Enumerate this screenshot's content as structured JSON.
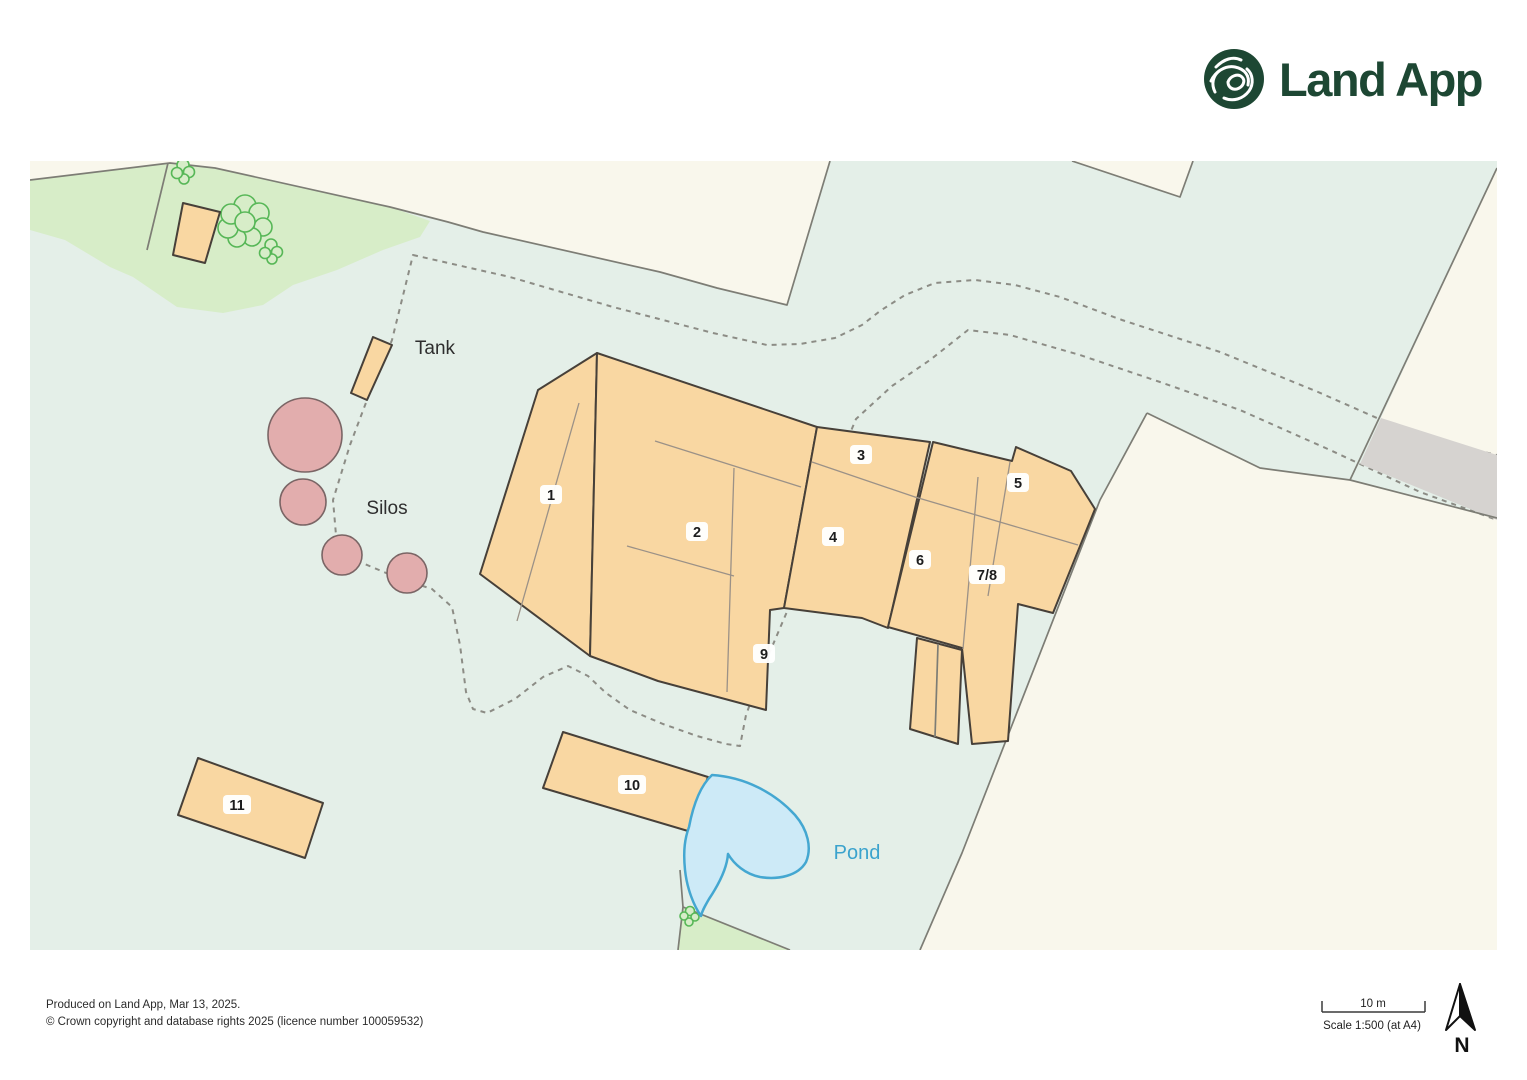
{
  "header": {
    "logo_text": "Land App"
  },
  "map": {
    "area_labels": {
      "tank": "Tank",
      "silos": "Silos",
      "pond": "Pond"
    },
    "buildings": [
      {
        "label": "1"
      },
      {
        "label": "2"
      },
      {
        "label": "3"
      },
      {
        "label": "4"
      },
      {
        "label": "5"
      },
      {
        "label": "6"
      },
      {
        "label": "7/8"
      },
      {
        "label": "9"
      },
      {
        "label": "10"
      },
      {
        "label": "11"
      }
    ],
    "colors": {
      "field_green": "#e4efe8",
      "grass_green": "#d7edc8",
      "cream": "#f9f7ec",
      "yard_grey": "#dfdbd8",
      "building_fill": "#f9d7a2",
      "building_outline": "#474039",
      "silo_fill": "#e2adad",
      "pond_fill": "#cdeaf7",
      "pond_outline": "#44a7d1",
      "tree_green": "#57b757",
      "logo_green": "#1d4733"
    }
  },
  "footer": {
    "produced_line": "Produced on Land App, Mar 13, 2025.",
    "copyright_line": "© Crown copyright and database rights 2025 (licence number 100059532)"
  },
  "scale_bar": {
    "distance_label": "10 m",
    "scale_label": "Scale 1:500 (at A4)"
  },
  "compass": {
    "north_label": "N"
  }
}
